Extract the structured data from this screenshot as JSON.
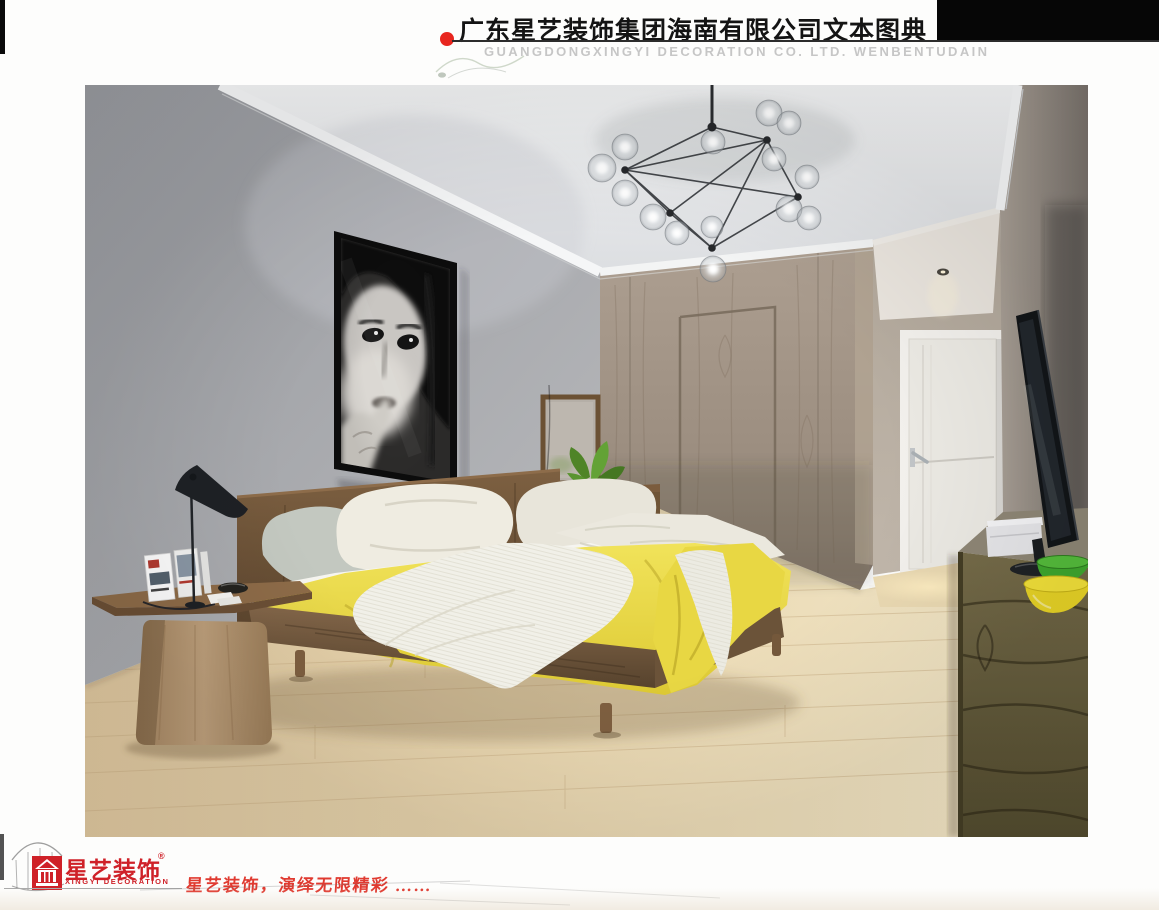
{
  "page": {
    "width": 1159,
    "height": 910,
    "background": "#fdfdfc"
  },
  "header": {
    "title": "广东星艺装饰集团海南有限公司文本图典",
    "watermark": "GUANGDONGXINGYI DECORATION CO. LTD. WENBENTUDAIN",
    "bullet_color": "#e8261f",
    "bar_color": "#060606"
  },
  "footer": {
    "logo_name": "星艺装饰",
    "logo_registered": "®",
    "logo_subtitle": "XINGYI DECORATION",
    "logo_color": "#cf2128",
    "slogan": "星艺装饰，演绎无限精彩 ……",
    "slogan_color": "#e03a30"
  },
  "image": {
    "description": "3D rendering of a modern bedroom interior",
    "objects": [
      "molecular glass-globe chandelier",
      "black and white woman portrait artwork",
      "walnut platform bed with yellow blanket and white knit throw",
      "gray and cream pillows",
      "wood pedestal side table with magazines",
      "black AJ desk lamp",
      "dresser with mirror and green plant",
      "wood panel wardrobe wall with sliding door",
      "corridor with white door and downlight",
      "flat screen TV on long dark wood console",
      "green bowl",
      "yellow bowl",
      "light maple plank floor"
    ],
    "palette": {
      "left_wall": "#a3a4a8",
      "wood_wall": "#a5978a",
      "floor": "#e2cda6",
      "blanket_yellow": "#e9d94f",
      "bed_wood": "#6e5338",
      "console_wood": "#6b6242",
      "bowl_green": "#3fa82e",
      "bowl_yellow": "#f3e23a"
    }
  }
}
